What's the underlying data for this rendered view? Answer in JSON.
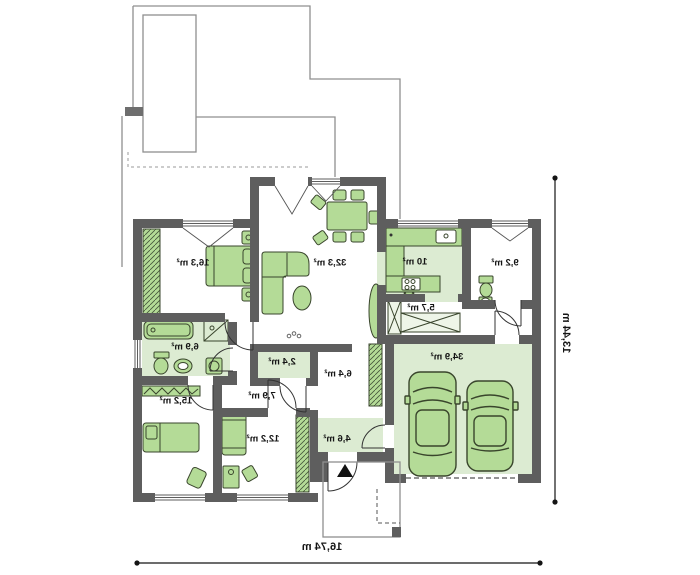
{
  "plan": {
    "rooms": [
      {
        "id": "bedroom-1",
        "area": "16,3 m²"
      },
      {
        "id": "living-room",
        "area": "32,3 m²"
      },
      {
        "id": "kitchen",
        "area": "10 m²"
      },
      {
        "id": "bathroom-2",
        "area": "9,2 m²"
      },
      {
        "id": "pantry",
        "area": "5,7 m²"
      },
      {
        "id": "bathroom-1",
        "area": "6,9 m²"
      },
      {
        "id": "wc",
        "area": "2,4 m²"
      },
      {
        "id": "hall",
        "area": "6,4 m²"
      },
      {
        "id": "corridor",
        "area": "7,9 m²"
      },
      {
        "id": "bedroom-2",
        "area": "15,2 m²"
      },
      {
        "id": "bedroom-3",
        "area": "12,2 m²"
      },
      {
        "id": "vestibule",
        "area": "4,6 m²"
      },
      {
        "id": "garage",
        "area": "34,9 m²"
      }
    ],
    "dimensions": {
      "width_label": "16,74 m",
      "height_label": "13,44 m"
    },
    "icons": {
      "entrance_arrow": "triangle-up"
    },
    "style": {
      "wall_color": "#5e5e5e",
      "furniture_fill": "#b4db97",
      "floor_tint": "#dcebd2",
      "roof_line_color": "#8f8f8f",
      "text_mirrored": true
    }
  }
}
